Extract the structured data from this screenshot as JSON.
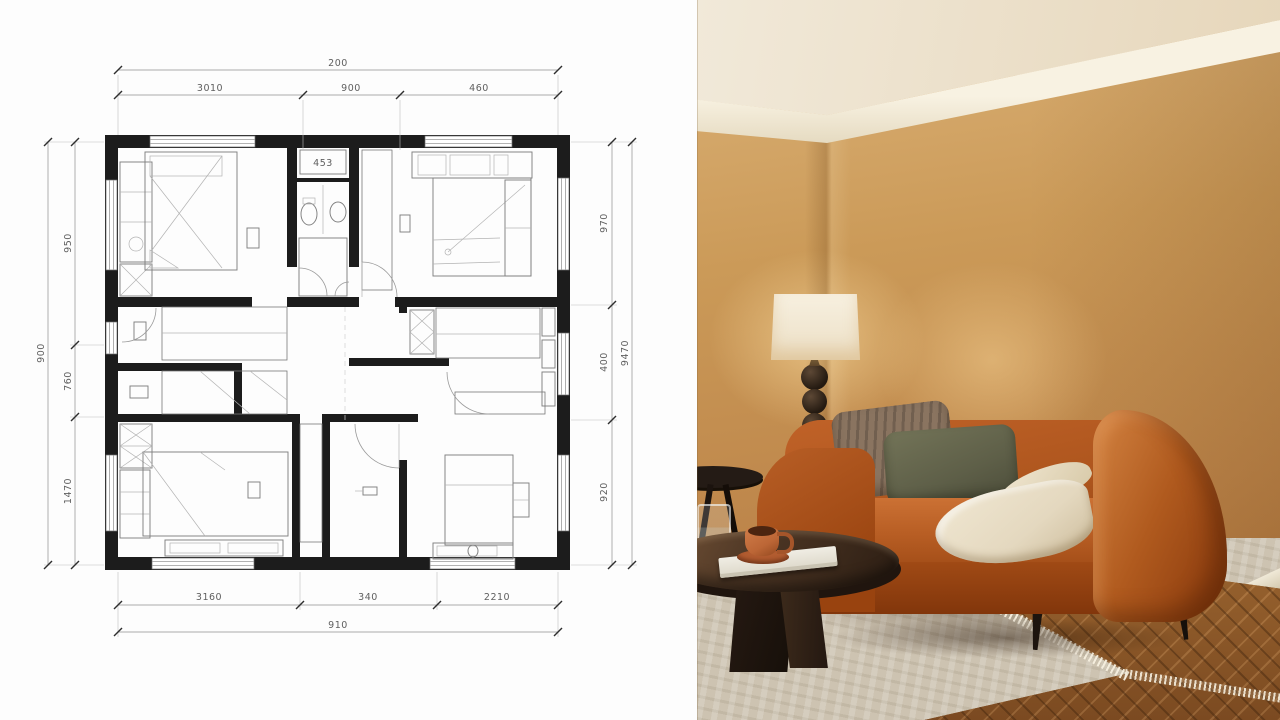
{
  "meta": {
    "view_title": "Floor plan with living room photo",
    "left_panel": "architectural-floor-plan",
    "right_panel": "living-room-photograph"
  },
  "floor_plan": {
    "bathroom_label": "453",
    "dimensions": {
      "top": {
        "total": "200",
        "segments": [
          "3010",
          "900",
          "460"
        ]
      },
      "bottom": {
        "total": "910",
        "segments": [
          "3160",
          "340",
          "2210"
        ]
      },
      "left": {
        "total": "900",
        "segments": [
          "950",
          "760",
          "1470"
        ]
      },
      "right": {
        "total": "9470",
        "segments": [
          "970",
          "400",
          "920"
        ]
      }
    },
    "colors": {
      "wall": "#1c1c1c",
      "line": "#8c8c8c"
    }
  },
  "photo": {
    "colors": {
      "wall": "#cb9a58",
      "ceiling": "#f1e9d9",
      "molding": "#f8f2e2",
      "sofa": "#ad551d",
      "pillow_brown": "#8a7460",
      "pillow_olive": "#5e5f48",
      "throw": "#e4d8bf",
      "table_wood": "#4a3423",
      "rug": "#cdc3b1",
      "floor_wood": "#8a572b",
      "lamp_shade": "#ecdfc5",
      "cup": "#bc6636"
    }
  }
}
